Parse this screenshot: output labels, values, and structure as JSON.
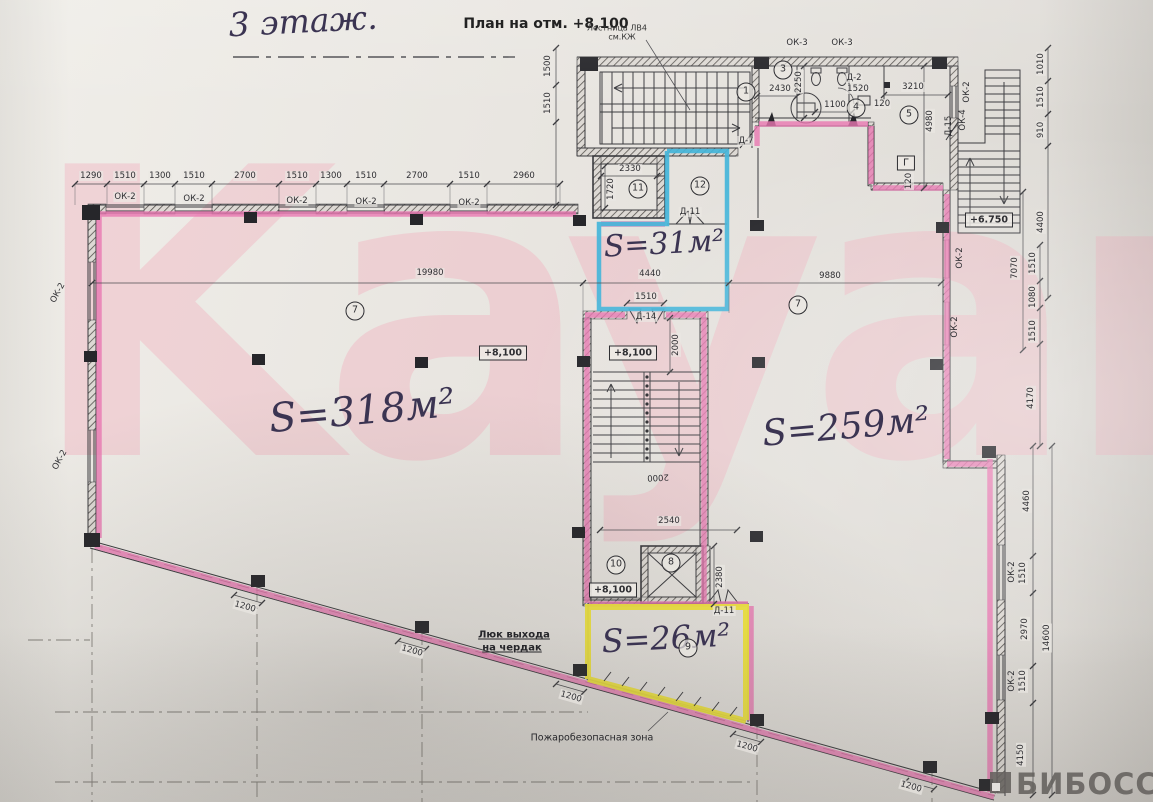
{
  "document": {
    "floor_title": "3 этаж.",
    "plan_title": "План на отм. +8,100",
    "stair_note": "Лестница ЛВ4",
    "stair_note2": "см.КЖ"
  },
  "watermarks": {
    "brand": "Kayan",
    "portal": "БИБОСС"
  },
  "rooms": {
    "hall_left": {
      "number": "7",
      "area": "S=318м²"
    },
    "hall_right": {
      "number": "7",
      "area": "S=259м²"
    },
    "room_blue": {
      "number": "12",
      "area": "S=31м²"
    },
    "room_yellow": {
      "number": "9",
      "area": "S=26м²"
    },
    "stairwell": "1",
    "wc_1": "3",
    "wc_2": "4",
    "room_5": "5",
    "lift_small": "8",
    "room_10": "10",
    "lift_main": "11"
  },
  "elevations": {
    "floor_level": "+8,100",
    "landing_level": "+6.750"
  },
  "annotations": {
    "attic_hatch_1": "Люк выхода",
    "attic_hatch_2": "на чердак",
    "fire_zone": "Пожаробезопасная зона",
    "gas_symbol": "Г"
  },
  "openings": {
    "window_ok2": "ОК-2",
    "window_ok3": "ОК-3",
    "window_ok4": "ОК-4",
    "door_d2": "Д-2",
    "door_d7": "Д-7",
    "door_d11": "Д-11",
    "door_d14": "Д-14",
    "door_d15": "Д-15"
  },
  "dimensions": {
    "top_chain": [
      "1290",
      "1510",
      "1300",
      "1510",
      "2700",
      "1510",
      "1300",
      "1510",
      "2700",
      "1510",
      "2960"
    ],
    "left_chain": [
      "1500",
      "1510"
    ],
    "right_chain_upper": [
      "1010",
      "1510",
      "910",
      "4400"
    ],
    "right_chain_middle": [
      "7070",
      "1510",
      "1080",
      "1510",
      "4170"
    ],
    "right_chain_lower": [
      "4460",
      "1510",
      "2970",
      "1510",
      "4150",
      "14600"
    ],
    "interior_spans": [
      "19980",
      "4440",
      "9880"
    ],
    "stair_core": {
      "width_top": "2000",
      "landing": "2540",
      "mark": "2000",
      "lift_shaft": "2380",
      "door_width": "1510"
    },
    "lift_main": {
      "width": "2330",
      "depth": "1720"
    },
    "wc_block": {
      "left": "2430",
      "depth": "2250",
      "mid": "1100",
      "wall": "120",
      "door": "1520",
      "width": "3210",
      "height": "4980",
      "wall2": "120"
    },
    "column_offset": "1200"
  }
}
